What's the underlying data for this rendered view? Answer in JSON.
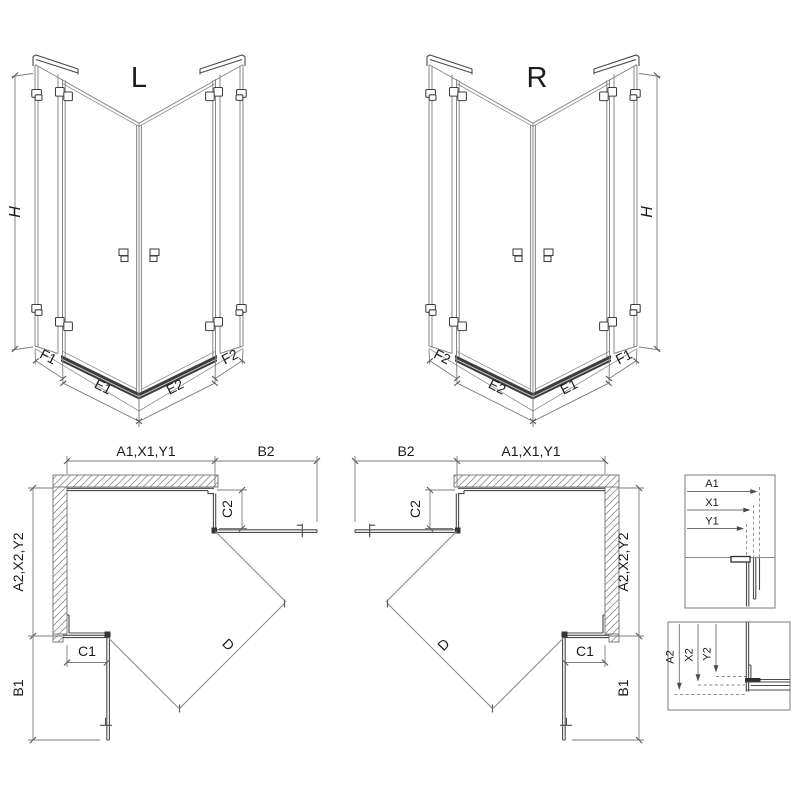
{
  "colors": {
    "background": "#ffffff",
    "line": "#878787",
    "dark_line": "#4a4a4a",
    "text": "#1b1b1b",
    "threshold": "#3c3c3c",
    "hatch": "#949494"
  },
  "iso_left": {
    "title": "L",
    "height": "H",
    "panel_outer_left": "F1",
    "door_left": "E1",
    "door_right": "E2",
    "panel_outer_right": "F2"
  },
  "iso_right": {
    "title": "R",
    "height": "H",
    "panel_outer_left": "F2",
    "door_left": "E2",
    "door_right": "E1",
    "panel_outer_right": "F1"
  },
  "plan_left": {
    "width_top": "A1,X1,Y1",
    "return_top": "B2",
    "fixed_segment_right": "C2",
    "depth_side": "A2,X2,Y2",
    "fixed_segment_bottom": "C1",
    "return_bottom": "B1",
    "diagonal_entry": "D"
  },
  "plan_right": {
    "width_top": "A1,X1,Y1",
    "return_top": "B2",
    "fixed_segment_left": "C2",
    "depth_side": "A2,X2,Y2",
    "fixed_segment_bottom": "C1",
    "return_bottom": "B1",
    "diagonal_entry": "D"
  },
  "detail_widths": {
    "row1": "A1",
    "row2": "X1",
    "row3": "Y1"
  },
  "detail_depths": {
    "row1": "A2",
    "row2": "X2",
    "row3": "Y2"
  }
}
